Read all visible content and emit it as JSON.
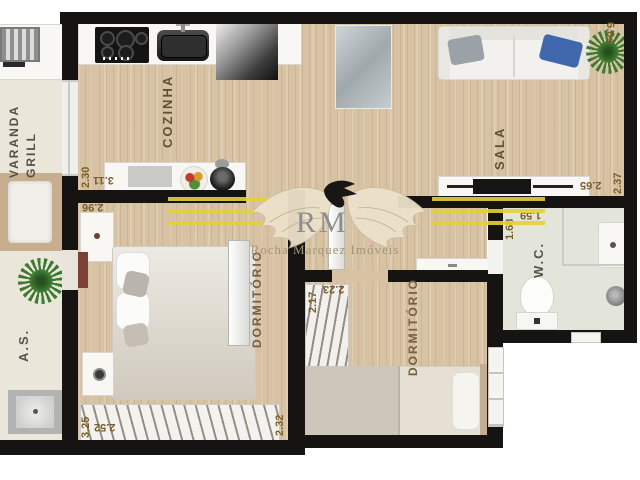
{
  "watermark": {
    "initials": "RM",
    "company": "Rocha Marquez Imóveis"
  },
  "colors": {
    "wall": "#151413",
    "wood_floor": "#d8c2a4",
    "balcony_floor": "#eae6da",
    "wc_floor": "#e3e5da",
    "watermark_yellow": "#e4d03c",
    "label_brown": "#5e5039",
    "dim_brown": "#7c5e28"
  },
  "rooms": {
    "varanda": {
      "line1": "VARANDA",
      "line2": "GRILL"
    },
    "cozinha": {
      "name": "COZINHA",
      "width": "3.11",
      "depth": "2.30"
    },
    "sala": {
      "name": "SALA",
      "side": "6.64",
      "width": "2.65",
      "depth": "2.37"
    },
    "wc": {
      "name": "W.C.",
      "width": "1.59",
      "depth": "1.68"
    },
    "dormitorio1": {
      "name": "DORMITÓRIO",
      "top": "2.96",
      "depth": "3.25",
      "width": "2.52",
      "side": "2.32"
    },
    "dormitorio2": {
      "name": "DORMITÓRIO",
      "depth": "2.17",
      "width": "2.23"
    },
    "servico": {
      "name": "A.S."
    }
  }
}
